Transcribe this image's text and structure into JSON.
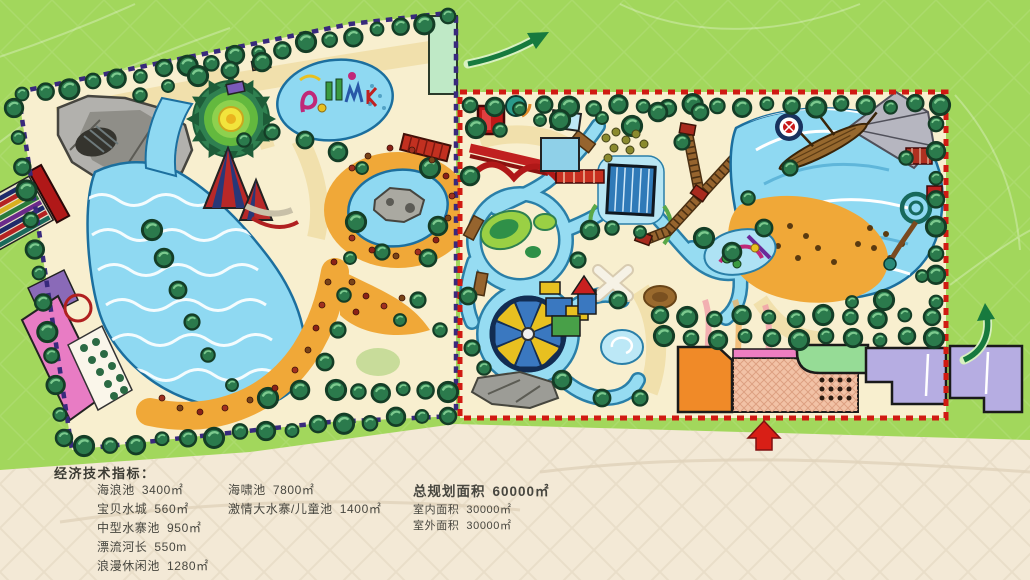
{
  "indicators": {
    "title": "经济技术指标：",
    "column1": [
      {
        "label": "海浪池",
        "value": "3400㎡"
      },
      {
        "label": "宝贝水城",
        "value": "560㎡"
      },
      {
        "label": "中型水寨池",
        "value": "950㎡"
      },
      {
        "label": "漂流河长",
        "value": "550m"
      },
      {
        "label": "浪漫休闲池",
        "value": "1280㎡"
      }
    ],
    "column2": [
      {
        "label": "海啸池",
        "value": "7800㎡"
      },
      {
        "label": "激情大水寨/儿童池",
        "value": "1400㎡"
      }
    ],
    "summary": {
      "label": "总规划面积",
      "value": "60000㎡"
    },
    "summary_details": [
      {
        "label": "室内面积",
        "value": "30000㎡"
      },
      {
        "label": "室外面积",
        "value": "30000㎡"
      }
    ]
  },
  "map": {
    "colors": {
      "background_green": "#a2d75c",
      "background_sand": "#f3e9d6",
      "park_ground": "#f8efcf",
      "water": "#8fd9f2",
      "beach_sand": "#f0a838",
      "left_park_border": "#38297c",
      "right_park_border": "#d01a12",
      "entrance_arrow": "#d81f16",
      "direction_arrow": "#177a3e"
    }
  }
}
